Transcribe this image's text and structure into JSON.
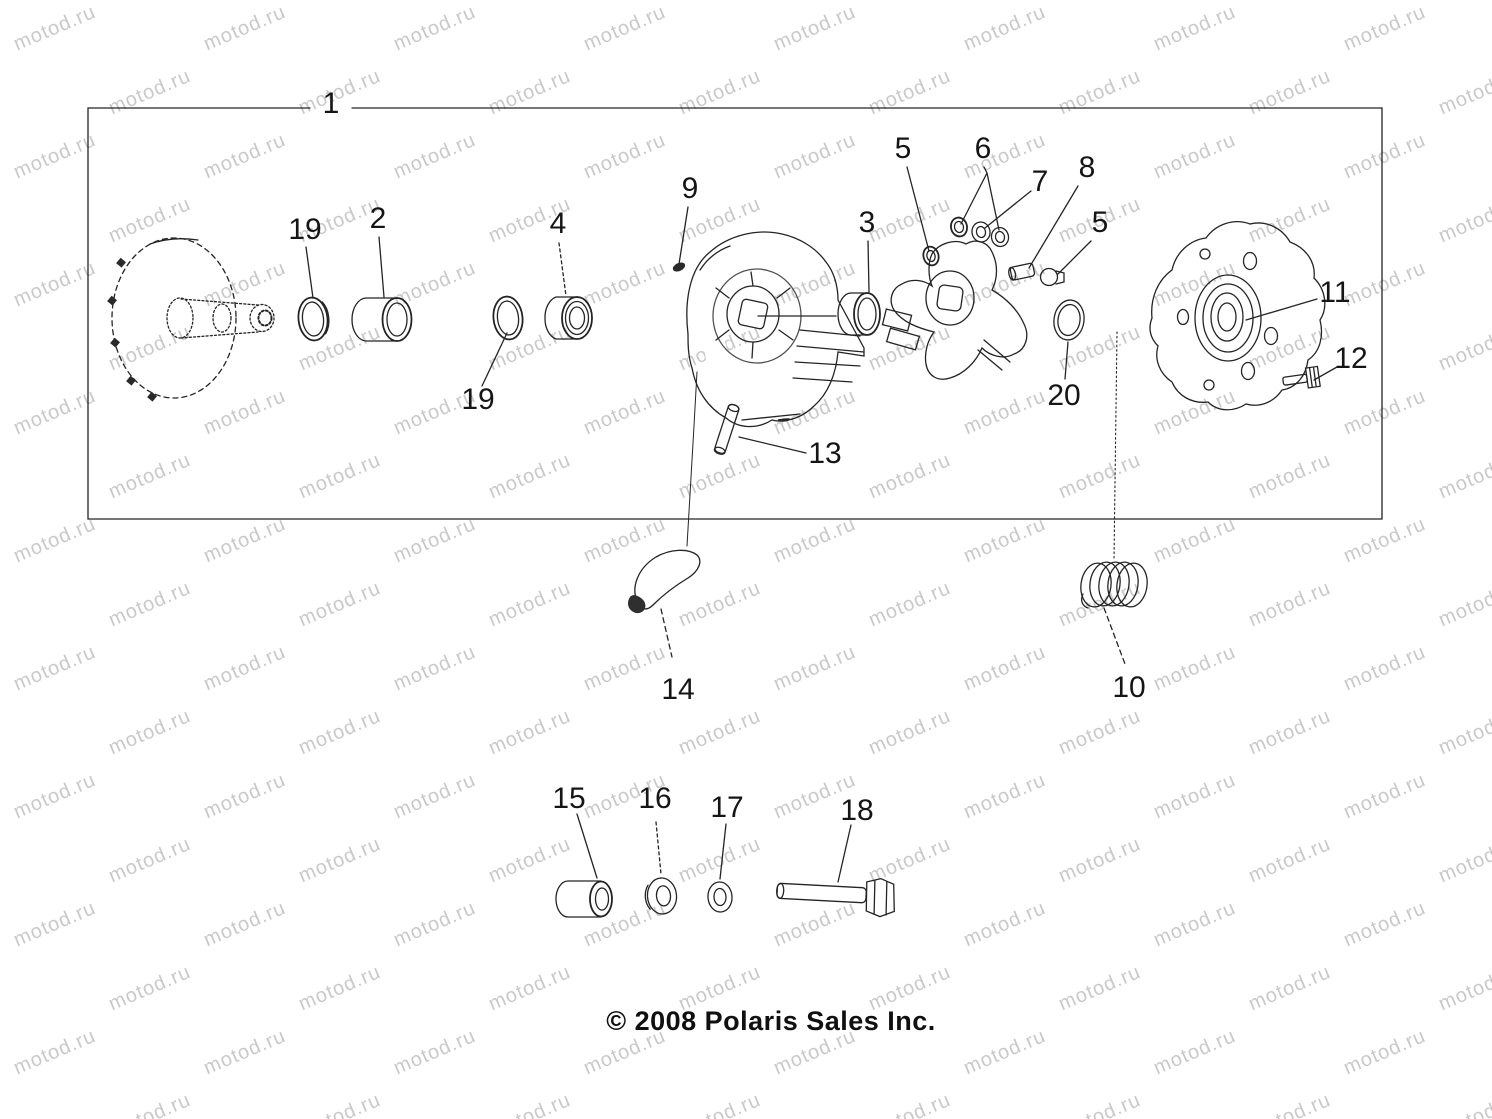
{
  "watermark": {
    "text": "motod.ru"
  },
  "footer": {
    "copyright": "© 2008 Polaris Sales Inc."
  },
  "diagram": {
    "type": "exploded-parts-diagram",
    "subject": "drive clutch assembly"
  },
  "callouts": [
    {
      "part": "clutch-assembly-box",
      "label": "1"
    },
    {
      "part": "o-ring-front",
      "label": "19"
    },
    {
      "part": "sleeve-bushing",
      "label": "2"
    },
    {
      "part": "flanged-bushing",
      "label": "4"
    },
    {
      "part": "o-ring-rear",
      "label": "19"
    },
    {
      "part": "retainer-clip",
      "label": "9"
    },
    {
      "part": "cover-bushing",
      "label": "3"
    },
    {
      "part": "roller-washer-left",
      "label": "5"
    },
    {
      "part": "washer-pair",
      "label": "6"
    },
    {
      "part": "washer-middle",
      "label": "7"
    },
    {
      "part": "pin",
      "label": "8"
    },
    {
      "part": "plug-right",
      "label": "5"
    },
    {
      "part": "spacer-ring",
      "label": "20"
    },
    {
      "part": "cover-plate-hub",
      "label": "11"
    },
    {
      "part": "cover-plate-bolt",
      "label": "12"
    },
    {
      "part": "roll-pin",
      "label": "13"
    },
    {
      "part": "clutch-weight",
      "label": "14"
    },
    {
      "part": "clutch-spring",
      "label": "10"
    },
    {
      "part": "spacer-bushing",
      "label": "15"
    },
    {
      "part": "thick-washer",
      "label": "16"
    },
    {
      "part": "thin-washer",
      "label": "17"
    },
    {
      "part": "weight-bolt",
      "label": "18"
    }
  ],
  "colors": {
    "ink": "#1f1f1f",
    "watermark": "#c9c9c9",
    "background": "#ffffff"
  }
}
